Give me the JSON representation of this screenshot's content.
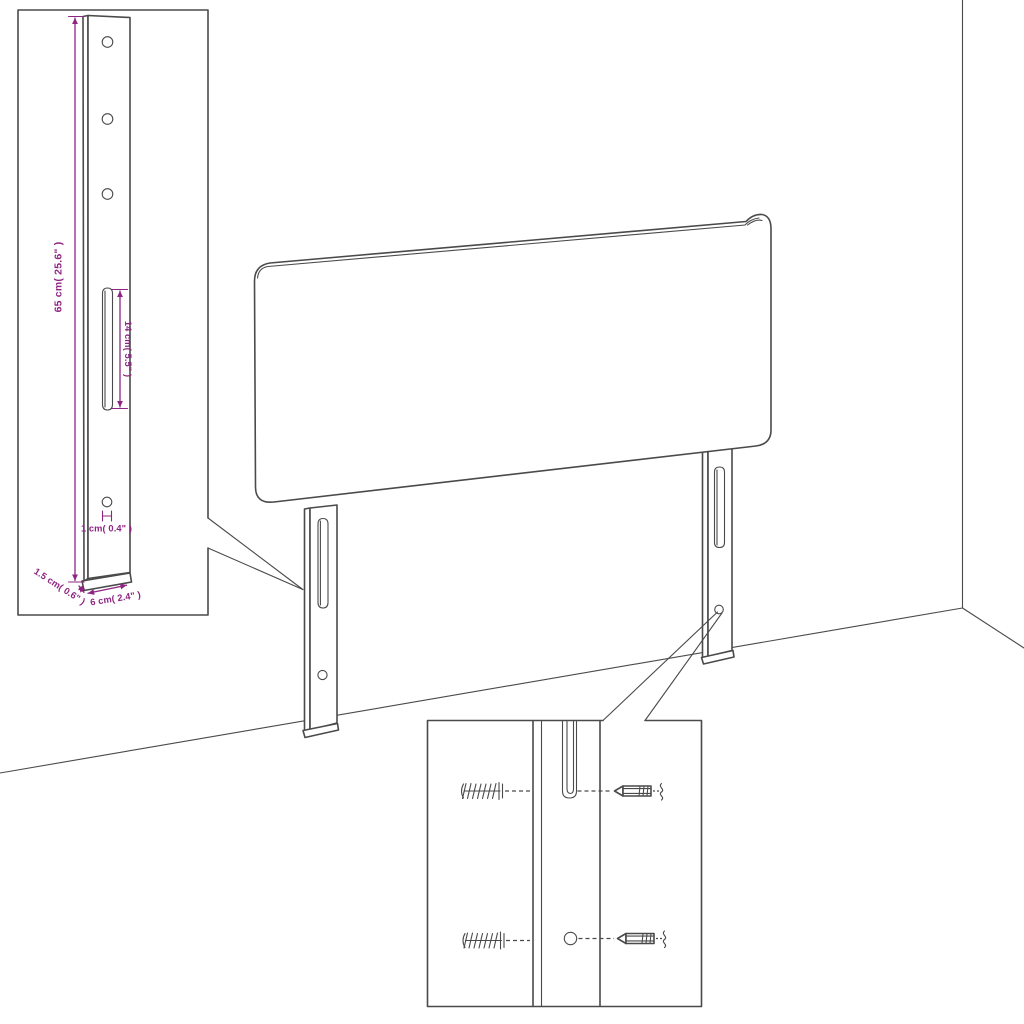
{
  "palette": {
    "background": "#ffffff",
    "outline": "#4a4a4a",
    "dimension": "#8e2582"
  },
  "main_drawing": {
    "subject": "headboard-with-two-mounting-legs-in-room-corner"
  },
  "leg_detail_inset": {
    "height_label": "65 cm( 25.6\" )",
    "slot_length_label": "14 cm( 5.5\" )",
    "hole_diameter_label": "1 cm( 0.4\" )",
    "depth_label": "1.5 cm( 0.6\" )",
    "width_label": "6 cm( 2.4\" )"
  },
  "mounting_detail_inset": {
    "icons": [
      "wall-plug-icon",
      "screw-icon"
    ]
  }
}
